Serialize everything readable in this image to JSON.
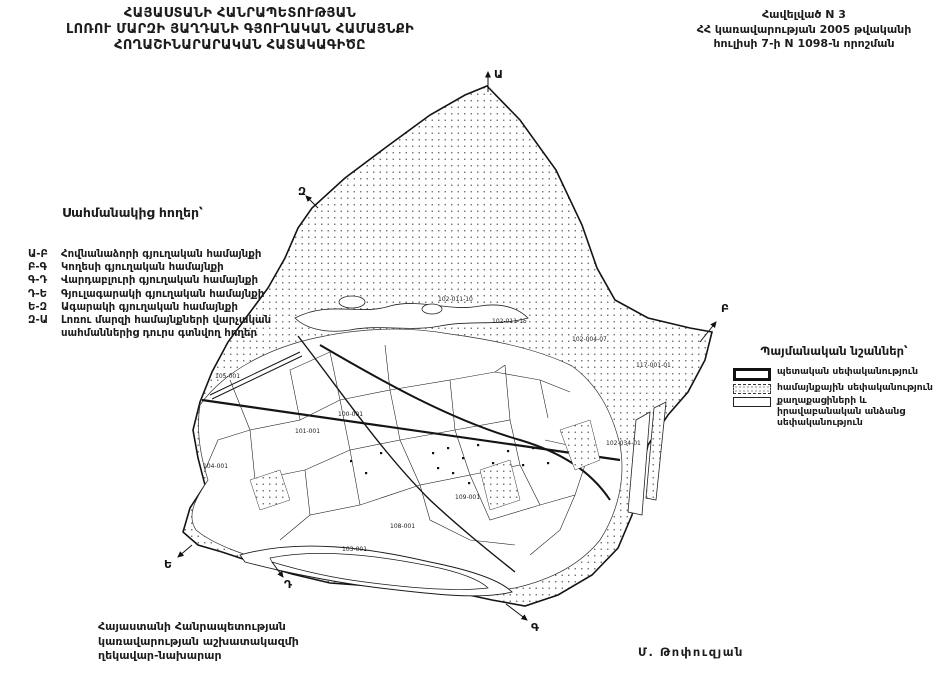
{
  "header": {
    "title_lines": [
      "ՀԱՅԱՍՏԱՆԻ ՀԱՆՐԱՊԵՏՈՒԹՅԱՆ",
      "ԼՈՌՈՒ ՄԱՐԶԻ ՅԱՂԴԱՆԻ ԳՅՈՒՂԱԿԱՆ ՀԱՄԱՅՆՔԻ",
      "ՀՈՂԱՇԻՆԱՐԱՐԱԿԱՆ ՀԱՏԱԿԱԳԻԾԸ"
    ]
  },
  "annex": {
    "lines": [
      "Հավելված N 3",
      "ՀՀ կառավարության 2005 թվականի",
      "հուլիսի 7-ի N 1098-ն որոշման"
    ]
  },
  "adjacent_lands": {
    "heading": "Սահմանակից հողեր՝",
    "items": [
      {
        "code": "Ա-Բ",
        "label": "Հովնանաձորի գյուղական համայնքի"
      },
      {
        "code": "Բ-Գ",
        "label": "Կողեսի գյուղական համայնքի"
      },
      {
        "code": "Գ-Դ",
        "label": "Վարդաբլուրի գյուղական համայնքի"
      },
      {
        "code": "Դ-Ե",
        "label": "Գյուլագարակի գյուղական համայնքի"
      },
      {
        "code": "Ե-Զ",
        "label": "Ագարակի գյուղական համայնքի"
      },
      {
        "code": "Զ-Ա",
        "label": "Լոռու մարզի համայնքների վարչական սահմաններից դուրս գտնվող հողեր"
      }
    ]
  },
  "legend": {
    "heading": "Պայմանական նշաններ՝",
    "items": [
      {
        "key": "state",
        "label": "պետական սեփականություն"
      },
      {
        "key": "community",
        "label": "համայնքային սեփականություն"
      },
      {
        "key": "private",
        "label": "քաղաքացիների և իրավաբանական անձանց սեփականություն"
      }
    ]
  },
  "map": {
    "letters": [
      "Ա",
      "Զ",
      "Բ",
      "Ե",
      "Դ",
      "Գ"
    ],
    "parcel_labels": [
      "105-001",
      "104-001",
      "101-001",
      "108-001",
      "103-001",
      "102-011-10",
      "102-011-15",
      "102-004-07",
      "117-001-01",
      "102-034-01",
      "100-001",
      "109-001"
    ]
  },
  "signature": {
    "lines": [
      "Հայաստանի Հանրապետության",
      "կառավարության աշխատակազմի",
      "ղեկավար-նախարար"
    ],
    "name": "Մ. Թոփուզյան"
  },
  "colors": {
    "paper": "#ffffff",
    "ink": "#1c1c1c",
    "stipple_dot": "#555555"
  }
}
